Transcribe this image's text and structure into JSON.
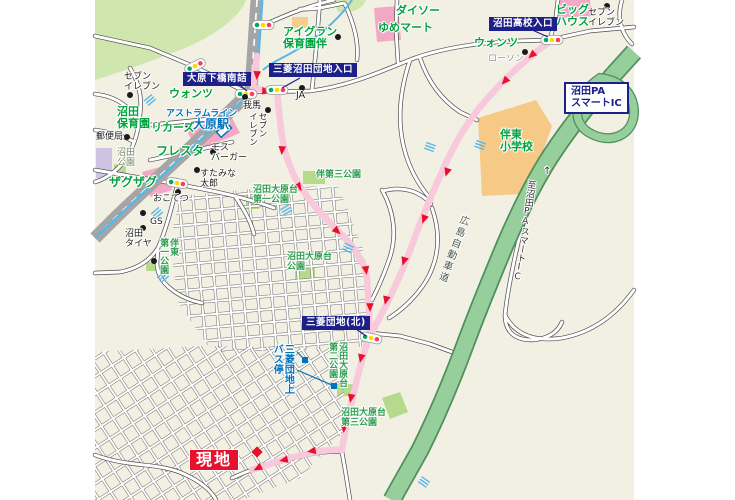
{
  "title": "現地案内図",
  "colors": {
    "background": "#f2efe3",
    "intersection_box": "#1d2088",
    "site_red": "#e8112d",
    "shop_green": "#00a33e",
    "transit_blue": "#0072bc",
    "route_pink": "#f8c9da",
    "expressway_green": "#96cf9b",
    "river_blue": "#57b7e8",
    "school_orange": "#f7c987"
  },
  "boxes": {
    "ohara_shimobashi": "大原下橋南詰",
    "mitsubishi_iriguchi": "三菱沼田団地入口",
    "numata_koko": "沼田高校入口",
    "mitsubishi_kita": "三菱団地(北)",
    "numata_pa": "沼田PA\nスマートIC"
  },
  "labels": {
    "seven_left": "セブン\nイレブン",
    "wants_left": "ウォンツ",
    "numata_hoikuen": "沼田\n保育園",
    "astram": "アストラムライン",
    "ohara_sta": "大原駅",
    "liquors": "リカーズ",
    "yubinkyoku": "郵便局",
    "numata_park": "沼田\n公園",
    "fresta": "フレスタ",
    "mos": "モス\nバーガー",
    "zagzag": "ザグザグ",
    "sutamina": "すたみな\n太郎",
    "okotetsu": "おこてつ",
    "gs": "GS",
    "numata_tire": "沼田\nタイヤ",
    "bando_dai1": "伴東\n第一公園",
    "ban_dai3": "伴第三公園",
    "oharadai_dai1": "沼田大原台\n第一公園",
    "oharadai": "沼田大原台\n公園",
    "oharadai_dai2": "沼田大原台\n第二公園",
    "oharadai_dai3": "沼田大原台\n第三公園",
    "busstop": "三菱団地上\nバス停",
    "gaba": "我馬",
    "seven_mid": "セブン\nイレブン",
    "ja": "JA",
    "aigran": "アイグラン\n保育園伴",
    "daiso": "ダイソー",
    "yumemart": "ゆめマート",
    "wants_right": "ウォンツ",
    "lawson": "ローソン",
    "bighouse": "ビッグ\nハウス",
    "seven_right": "セブン\nイレブン",
    "bando_es": "伴東\n小学校",
    "to_numata_pa": "至沼田PAスマートIC",
    "arrow_up": "↑",
    "expwy": "広島自動車道",
    "genchi": "現地"
  }
}
